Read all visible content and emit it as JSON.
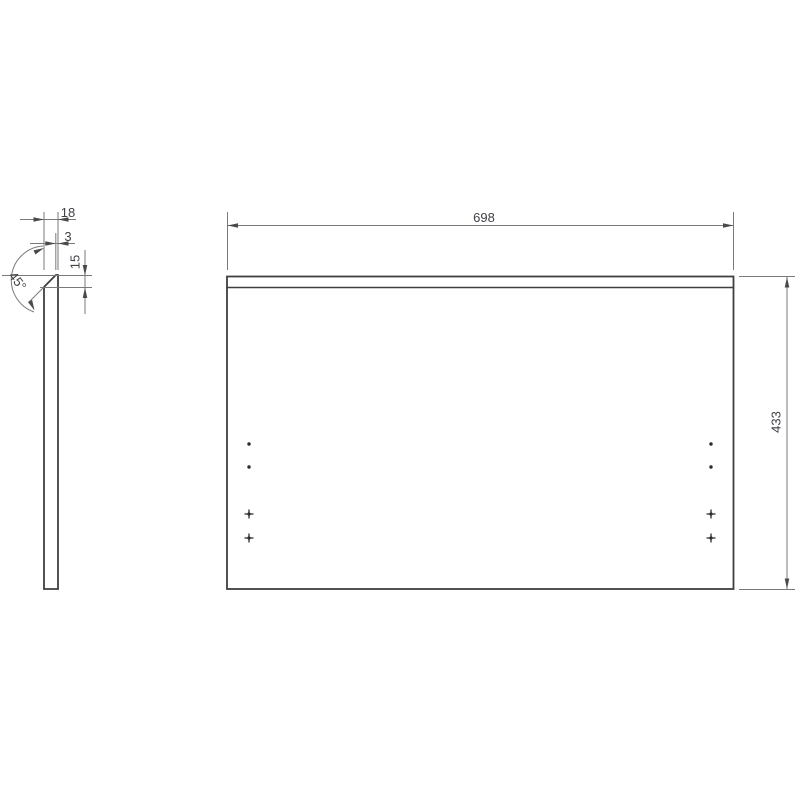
{
  "colors": {
    "background": "#ffffff",
    "model_line": "#3f3f3f",
    "dimension_line": "#7a7a7a",
    "arrow": "#4a4a4a",
    "text": "#3f3f46",
    "marker": "#2b2b2b"
  },
  "side_view": {
    "dim_thickness": "18",
    "dim_top_edge": "3",
    "dim_chamfer_height": "15",
    "dim_chamfer_angle": "45°"
  },
  "front_view": {
    "dim_width": "698",
    "dim_height": "433",
    "hole_markers": {
      "columns_x": [
        249,
        711
      ],
      "dot_rows_y": [
        444,
        467
      ],
      "cross_rows_y": [
        514,
        538
      ]
    }
  }
}
